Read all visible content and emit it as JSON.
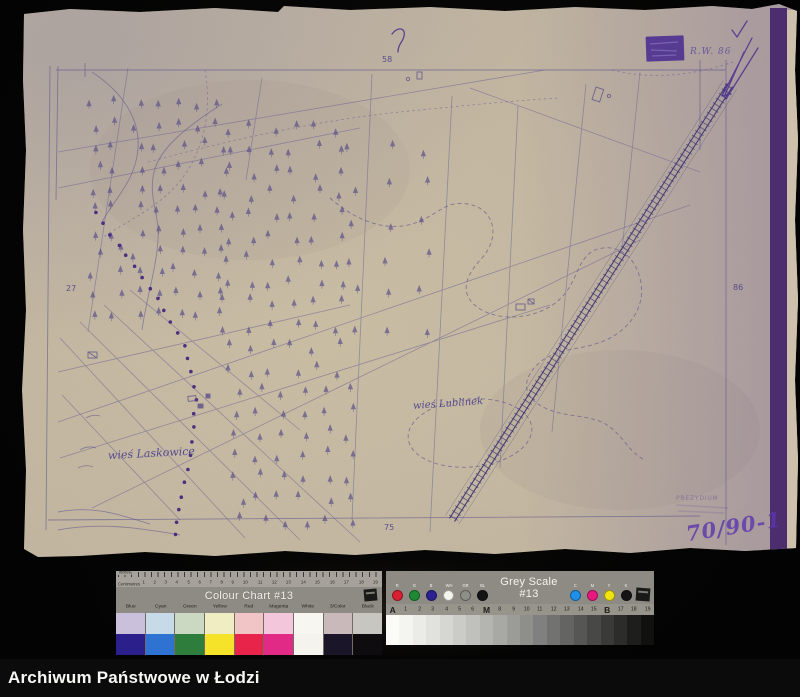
{
  "palette": {
    "background": "#060606",
    "paper": "#c3b7a2",
    "paper_right_tint": "#a89cab",
    "ink": "#5d538c",
    "ink_bold": "#4c2f8e",
    "stamp": "#4d3090",
    "binding_stripe": "#4c2d6d",
    "footer_bg": "#0b0b0b",
    "footer_text": "#f7f7f4"
  },
  "map": {
    "village_labels": {
      "laskowice": "wieś Laskowice",
      "lublinek": "wieś Lublinek"
    },
    "numbers": {
      "top": "58",
      "left": "27",
      "bottom": "75",
      "right": "86"
    },
    "stamp_caption": "R.W. 86",
    "stamp_office": "PREZYDIUM",
    "archival_number": "70/90-1"
  },
  "color_chart": {
    "title": "Colour Chart #13",
    "ruler_top_label": "Inches",
    "ruler_bottom_label": "Centimetres",
    "cm_ticks": [
      "1",
      "2",
      "3",
      "4",
      "5",
      "6",
      "7",
      "8",
      "9",
      "10",
      "11",
      "12",
      "13",
      "14",
      "15",
      "16",
      "17",
      "18",
      "19"
    ],
    "columns": [
      "Blue",
      "Cyan",
      "Green",
      "Yellow",
      "Red",
      "Magenta",
      "White",
      "3/Color",
      "Black"
    ],
    "pale_row": [
      "#cbc0dc",
      "#c6dae8",
      "#cbd9c3",
      "#f0edc2",
      "#f1c5c6",
      "#f3c6db",
      "#f8f6f0",
      "#cab9bb",
      "#c7c6c1"
    ],
    "solid_row": [
      "#2b1f8c",
      "#2e73d2",
      "#2e7d3c",
      "#f5e32a",
      "#e8244a",
      "#e02a85",
      "#f5f3ee",
      "#1a1528",
      "#0e0c0e"
    ]
  },
  "grey_scale": {
    "title": "Grey Scale #13",
    "dots_left": [
      {
        "label": "R",
        "color": "#d92030"
      },
      {
        "label": "G",
        "color": "#1e8a35"
      },
      {
        "label": "B",
        "color": "#2b2193"
      },
      {
        "label": "WH",
        "color": "#f5f5f0"
      },
      {
        "label": "GR",
        "color": "#8f8f89"
      },
      {
        "label": "BL",
        "color": "#141414"
      }
    ],
    "dots_right": [
      {
        "label": "C",
        "color": "#1e90e8"
      },
      {
        "label": "M",
        "color": "#e8187e"
      },
      {
        "label": "Y",
        "color": "#f2e410"
      },
      {
        "label": "K",
        "color": "#141414"
      }
    ],
    "scale_labels": [
      "A",
      "1",
      "2",
      "3",
      "4",
      "5",
      "6",
      "M",
      "8",
      "9",
      "10",
      "11",
      "12",
      "13",
      "14",
      "15",
      "B",
      "17",
      "18",
      "19"
    ],
    "steps": [
      "#fbfbf8",
      "#f4f4f0",
      "#ebebe7",
      "#e1e1dd",
      "#d6d6d2",
      "#cbcbc7",
      "#c0c0bc",
      "#b4b4b0",
      "#a8a8a4",
      "#9b9b97",
      "#8e8e8a",
      "#808080",
      "#727270",
      "#646462",
      "#565654",
      "#484846",
      "#3a3a38",
      "#2c2c2a",
      "#1e1e1c",
      "#111110"
    ]
  },
  "footer": {
    "title": "Archiwum Państwowe w Łodzi"
  }
}
